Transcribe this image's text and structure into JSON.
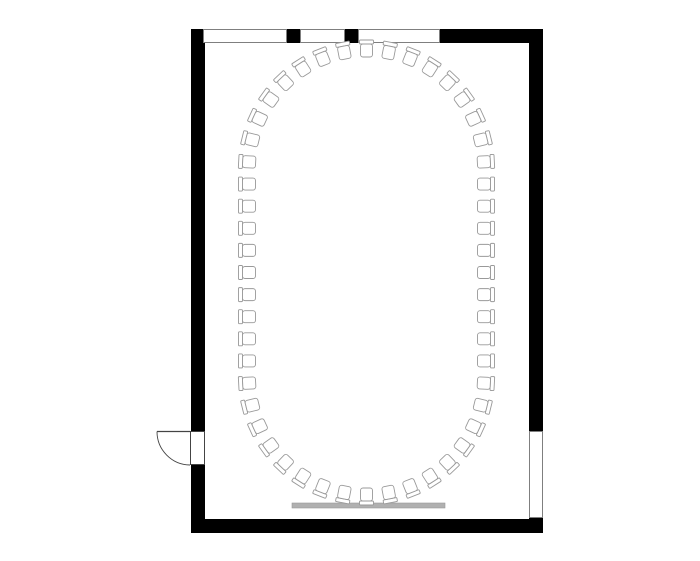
{
  "page": {
    "width": 700,
    "height": 561,
    "background": "#ffffff"
  },
  "plan": {
    "type": "floor-plan",
    "description": "conference-room-with-ring-seating",
    "colors": {
      "wall": "#000000",
      "room_fill": "#ffffff",
      "window_fill": "#ffffff",
      "window_outline": "#7f7f7f",
      "door_outline": "#444444",
      "chair_outline": "#999999",
      "chair_fill": "#ffffff",
      "screen_fill": "#b0b0b0",
      "screen_outline": "#9a9a9a"
    },
    "walls": {
      "outer": {
        "x": 191,
        "y": 29,
        "w": 352,
        "h": 504
      },
      "thickness": 14
    },
    "windows": [
      {
        "side": "top",
        "x": 203,
        "y": 29,
        "w": 84,
        "h": 14
      },
      {
        "side": "top",
        "x": 300,
        "y": 29,
        "w": 45,
        "h": 14
      },
      {
        "side": "top",
        "x": 358,
        "y": 29,
        "w": 82,
        "h": 14
      },
      {
        "side": "right",
        "x": 529,
        "y": 431,
        "w": 14,
        "h": 87
      }
    ],
    "door": {
      "side": "left",
      "swing": "outward-left",
      "opening": {
        "x": 190,
        "y": 431,
        "w": 15,
        "h": 34
      },
      "hinge": {
        "x": 190,
        "y": 431.5
      },
      "leaf_end": {
        "x": 157,
        "y": 431.5
      },
      "swing_radius": 33.5
    },
    "screen": {
      "x": 292,
      "y": 503,
      "w": 153,
      "h": 5
    },
    "chairs": {
      "count": 52,
      "arrangement": "stadium-ring",
      "center_x": 366.5,
      "cap_radius": 116.5,
      "top_cap_cy": 168,
      "bottom_cap_cy": 377,
      "seat": {
        "w": 12,
        "h": 13,
        "rx": 2.5
      },
      "backrest": {
        "w": 14,
        "h": 4,
        "rx": 1
      }
    }
  }
}
